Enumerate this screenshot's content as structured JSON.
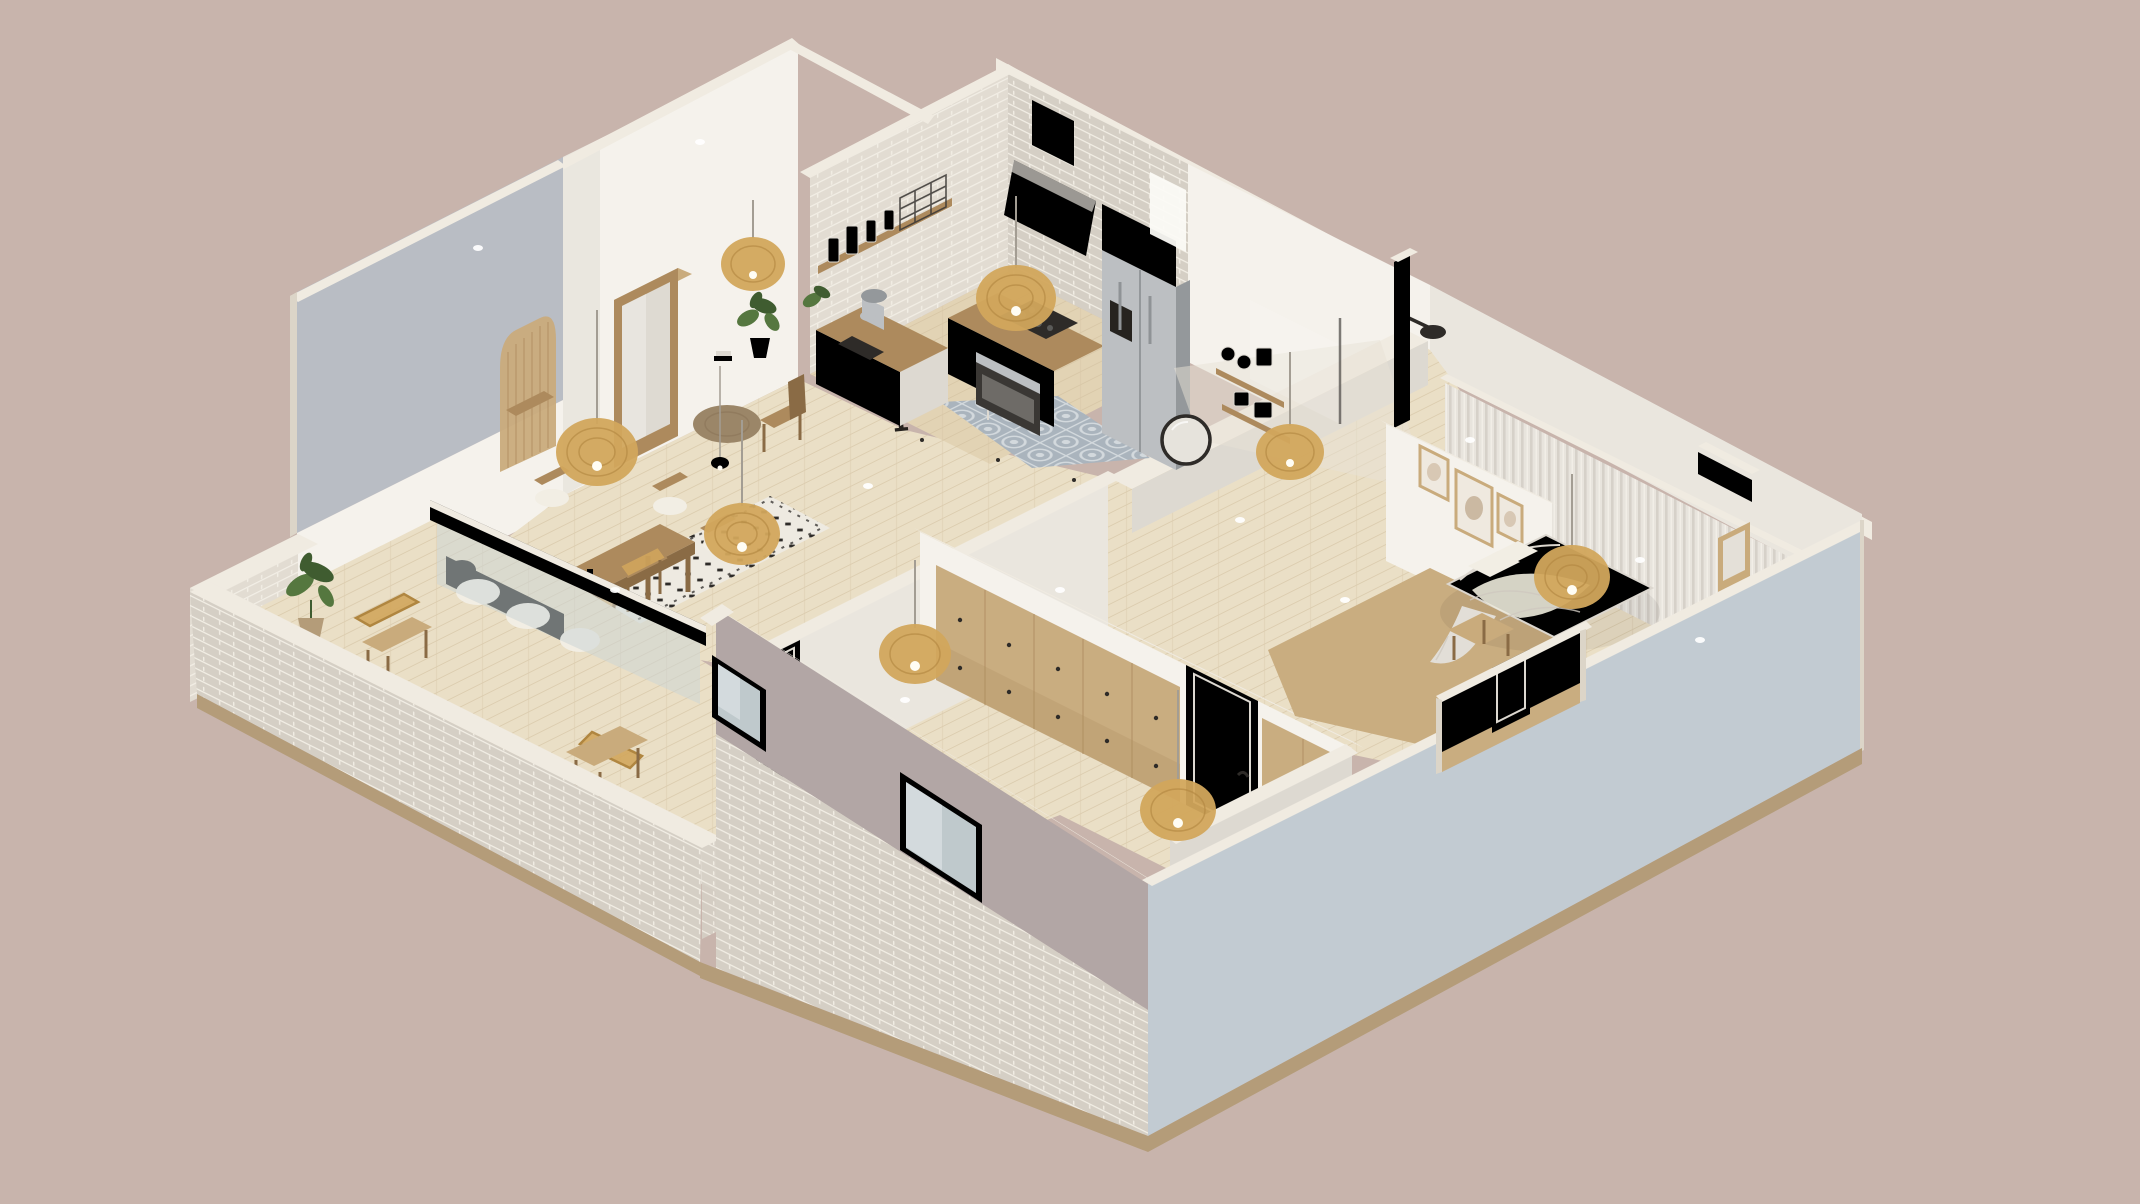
{
  "meta": {
    "type": "3d-isometric-floorplan-render",
    "style": "scandinavian-apartment-cutaway",
    "camera": "isometric-birdseye"
  },
  "palette": {
    "bg": "#c8b4ac",
    "cream": "#f0ebe1",
    "creamShadow": "#dcd5c8",
    "wallLit": "#f5f2ec",
    "wallMid": "#eae6de",
    "wallShadow": "#ddd9d1",
    "wallDim": "#cfccc5",
    "grayPlane": "#b9bdc4",
    "blueWall": "#c2cbd2",
    "mauveWall": "#b2a6a5",
    "brick": "#e2dcd2",
    "brickDark": "#d5cfc5",
    "mortar": "#f2eee5",
    "tanTrim": "#b49c79",
    "floor": "#e2d3b4",
    "floorLight": "#eadfc6",
    "plank": "#d0bd9c",
    "tile": "#aab4bd",
    "tileLight": "#d3d9dd",
    "tanFloor": "#c9ad80",
    "wood": "#ad8a5d",
    "woodDark": "#8a6b45",
    "woodLight": "#c9ab7c",
    "rattan": "#d2a65c",
    "rattanDark": "#b08640",
    "steel": "#bcbfc2",
    "steelDark": "#94989b",
    "black": "#2e2b28",
    "green": "#55773f",
    "greenDark": "#3f5c30",
    "cushion": "#f2eee4",
    "curtain": "#e8e4dd",
    "curtainDark": "#d6d1c9",
    "glassTint": "#ccd6d6",
    "jute": "#9b8668",
    "rugWhite": "#eeeae1"
  },
  "scene": {
    "backdrop": "plain mauve studio background",
    "rooms": [
      {
        "name": "kitchen",
        "features": [
          "white-brick-walls",
          "wood-counters",
          "black-cooktop",
          "built-in-oven",
          "white-range-hood",
          "stainless-fridge",
          "open-shelf-with-jars",
          "wire-basket",
          "stand-mixer",
          "rattan-pendant",
          "white-railing",
          "patterned-tile-floor",
          "bright-window"
        ]
      },
      {
        "name": "bathroom",
        "features": [
          "black-shower-set",
          "round-black-mirror",
          "wood-shelves-with-towels",
          "glass-partition",
          "rattan-pendant"
        ]
      },
      {
        "name": "bedroom",
        "features": [
          "double-bed-white-linen",
          "draped-throw-blanket",
          "wood-bench",
          "sheer-curtain-wall",
          "gallery-picture-frames",
          "rattan-pendant",
          "tan-carpet",
          "vanity-mirror"
        ]
      },
      {
        "name": "hallway",
        "features": [
          "tan-wardrobe-with-drawers",
          "white-interior-doors",
          "rattan-pendants",
          "tan-runner",
          "wall-numerals"
        ]
      },
      {
        "name": "living-dining",
        "features": [
          "long-wood-dining-table",
          "chairs-with-white-cushions",
          "black-white-patterned-rug",
          "two-rattan-pendants",
          "white-mini-pendant",
          "leaning-floor-mirror",
          "arched-fluted-niche",
          "round-jute-rug",
          "white-sofa",
          "house-plants",
          "wood-side-chair"
        ]
      },
      {
        "name": "second-room",
        "features": [
          "rattan-pendant",
          "white-door",
          "facade-windows"
        ]
      },
      {
        "name": "balcony",
        "features": [
          "whitewashed-brick-parapet",
          "two-rattan-armchairs",
          "potted-plants",
          "glass-sliding-door-wall"
        ]
      }
    ],
    "exterior": {
      "southwest_facade": "mauve plaster over whitewashed brick base with two windows",
      "southeast_facade": "pale blue-gray plaster with recessed entry notch and tan base trim",
      "wall_tops": "cream cut-away caps"
    },
    "decor": {
      "wall_numerals": [
        "2",
        "1"
      ]
    }
  }
}
